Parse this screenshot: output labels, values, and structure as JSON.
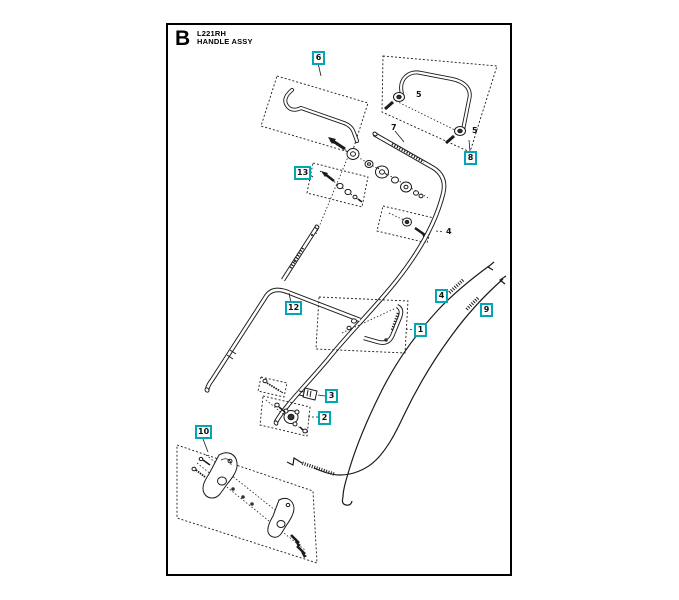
{
  "page": {
    "figure_letter": "B",
    "model": "L221RH",
    "assembly": "HANDLE ASSY"
  },
  "colors": {
    "callout_accent": "#00a7b5",
    "diagram_line": "#1a1a1a",
    "page_background": "#ffffff"
  },
  "callouts": {
    "drive_lever": "1",
    "handle_bracket": "2",
    "cable_clip": "3",
    "drive_cable": "4",
    "handle_rod": "6",
    "control_bail": "8",
    "cable": "9",
    "bracket_kit": "10",
    "lower_handle": "12",
    "hardware_kit": "13"
  },
  "part_labels": {
    "upper_handle": "7",
    "knob_front": "5",
    "knob_rear": "5",
    "cable_hardware": "4"
  }
}
